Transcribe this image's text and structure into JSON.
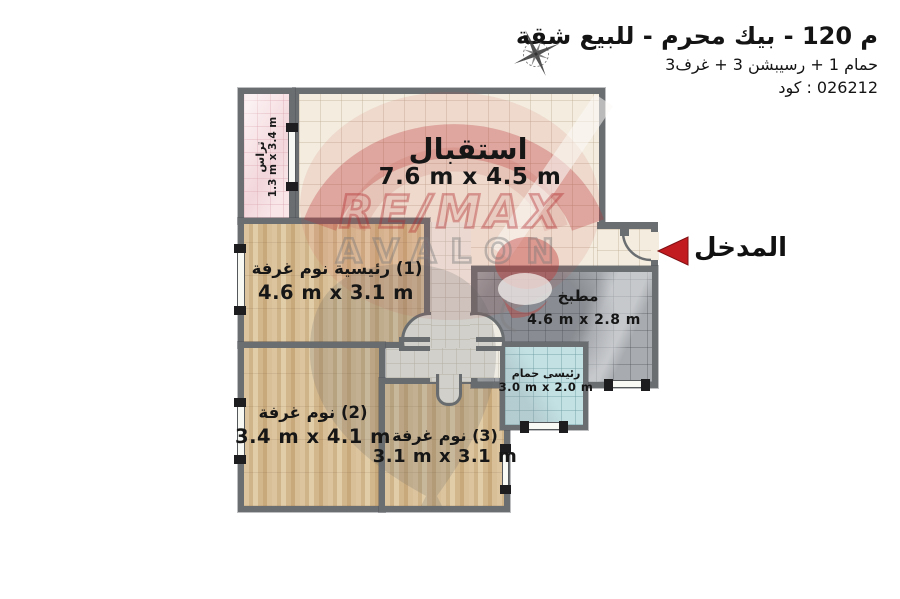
{
  "header": {
    "title": "شقة‎ للبيع‎ - محرم‎ بيك‎ - 120 م",
    "subtitle": "3غرف‎ + 3 رسيبشن‎ + 1 حمام",
    "code": "كود‎ : 026212"
  },
  "entrance": {
    "label": "المدخل"
  },
  "watermark": {
    "remax": "RE/MAX",
    "avalon": "AVALON"
  },
  "rooms": {
    "reception": {
      "name": "استقبال",
      "dims": "7.6 m x 4.5 m"
    },
    "terrace": {
      "name": "تراس",
      "dims": "1.3 m x 3.4 m"
    },
    "bedroom1": {
      "name": "غرفة‎ نوم‎ رئيسية‎ (1)",
      "dims": "4.6 m x 3.1 m"
    },
    "bedroom2": {
      "name": "غرفة‎ نوم‎ (2)",
      "dims": "3.4 m x 4.1 m"
    },
    "bedroom3": {
      "name": "غرفة‎ نوم‎ (3)",
      "dims": "3.1 m x 3.1 m"
    },
    "kitchen": {
      "name": "مطبخ",
      "dims": "4.6 m x 2.8 m"
    },
    "bathroom": {
      "name": "حمام‎ رئيسى",
      "dims": "3.0 m x 2.0 m"
    }
  },
  "colors": {
    "wall": "#6b6e71",
    "accent_red": "#c21b20",
    "floor_tile": "#f3ecdf",
    "floor_wood": "#d4ba92",
    "floor_kitchen": "#a8abaf",
    "floor_bath": "#c3e1e3",
    "floor_terrace": "#f8e6e9"
  }
}
